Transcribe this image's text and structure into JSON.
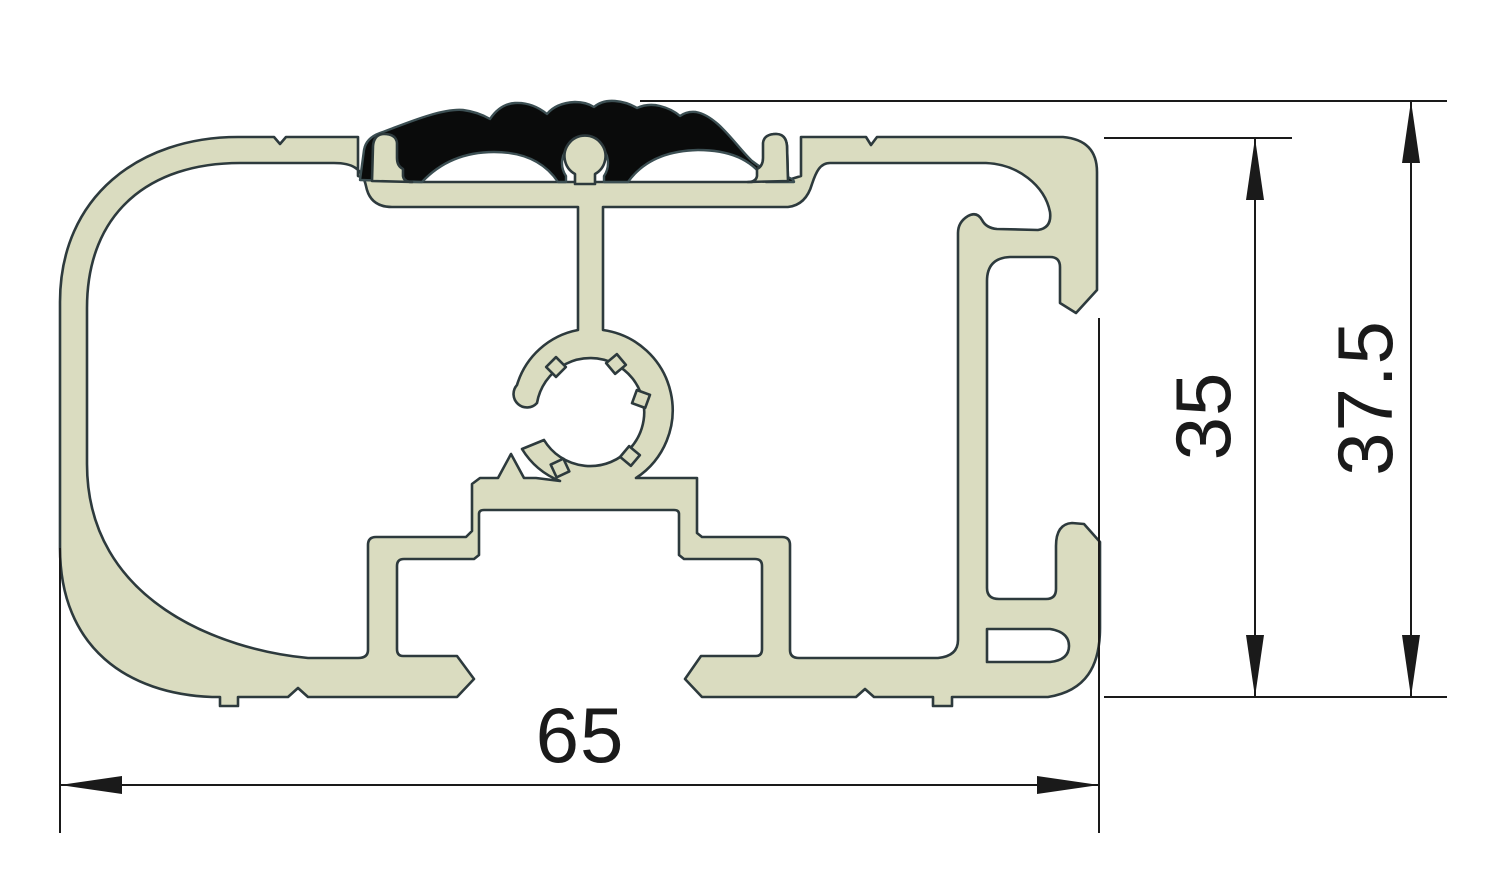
{
  "drawing": {
    "title": "Aluminium profile cross-section with anti-slip rubber insert",
    "units": "mm",
    "dimensions": {
      "width": {
        "label": "65",
        "orientation": "horizontal"
      },
      "inner_height": {
        "label": "35",
        "orientation": "vertical"
      },
      "overall_height": {
        "label": "37.5",
        "orertation": "vertical",
        "orientation": "vertical"
      }
    },
    "colors": {
      "aluminium_fill": "#dadcc0",
      "outline": "#2d3a3d",
      "rubber_fill": "#0a0b0b",
      "rubber_outline": "#3c4f53",
      "dimension_color": "#1a1a1a",
      "background": "#ffffff"
    }
  }
}
